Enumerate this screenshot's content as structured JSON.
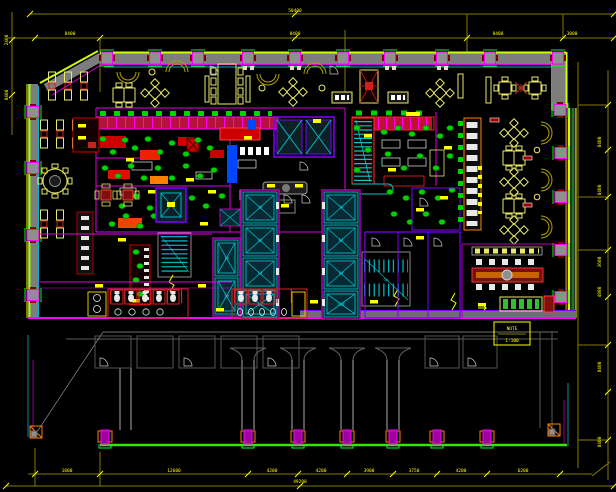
{
  "canvas": {
    "width": 616,
    "height": 492,
    "background": "#000000"
  },
  "palette": {
    "dimension_line": "#857a00",
    "dimension_text": "#ffff00",
    "wall_gray": "#7d7d7d",
    "curtain_wall_green": "#ccff00",
    "accent_green": "#00ff00",
    "accent_cyan": "#00e5ff",
    "accent_magenta": "#ff00ff",
    "accent_purple": "#8000ff",
    "equipment_red": "#ff2020",
    "furniture_yellow": "#e8e86a",
    "plant_green": "#00d400",
    "annex_gray": "#5a5a5a",
    "ground_line_green": "#39e600"
  },
  "dims": {
    "top_total": "50400",
    "top": [
      "8400",
      "8400",
      "8400",
      "3000"
    ],
    "right": [
      "8400",
      "8400",
      "3600",
      "4800",
      "8400",
      "8400"
    ],
    "bottom": [
      "1800",
      "12600",
      "4200",
      "4200",
      "3900",
      "3750",
      "4200",
      "6200"
    ],
    "bottom_total": "49200",
    "left": [
      "2400",
      "8400"
    ]
  },
  "core": {
    "elevator_labels": [
      "1#",
      "2#",
      "3#",
      "4#",
      "5#",
      "6#",
      "7#",
      "8#",
      "9#",
      "10#"
    ],
    "stair_label": "UP"
  },
  "note_box": {
    "line1": "NOTE",
    "line2": "1:100"
  }
}
